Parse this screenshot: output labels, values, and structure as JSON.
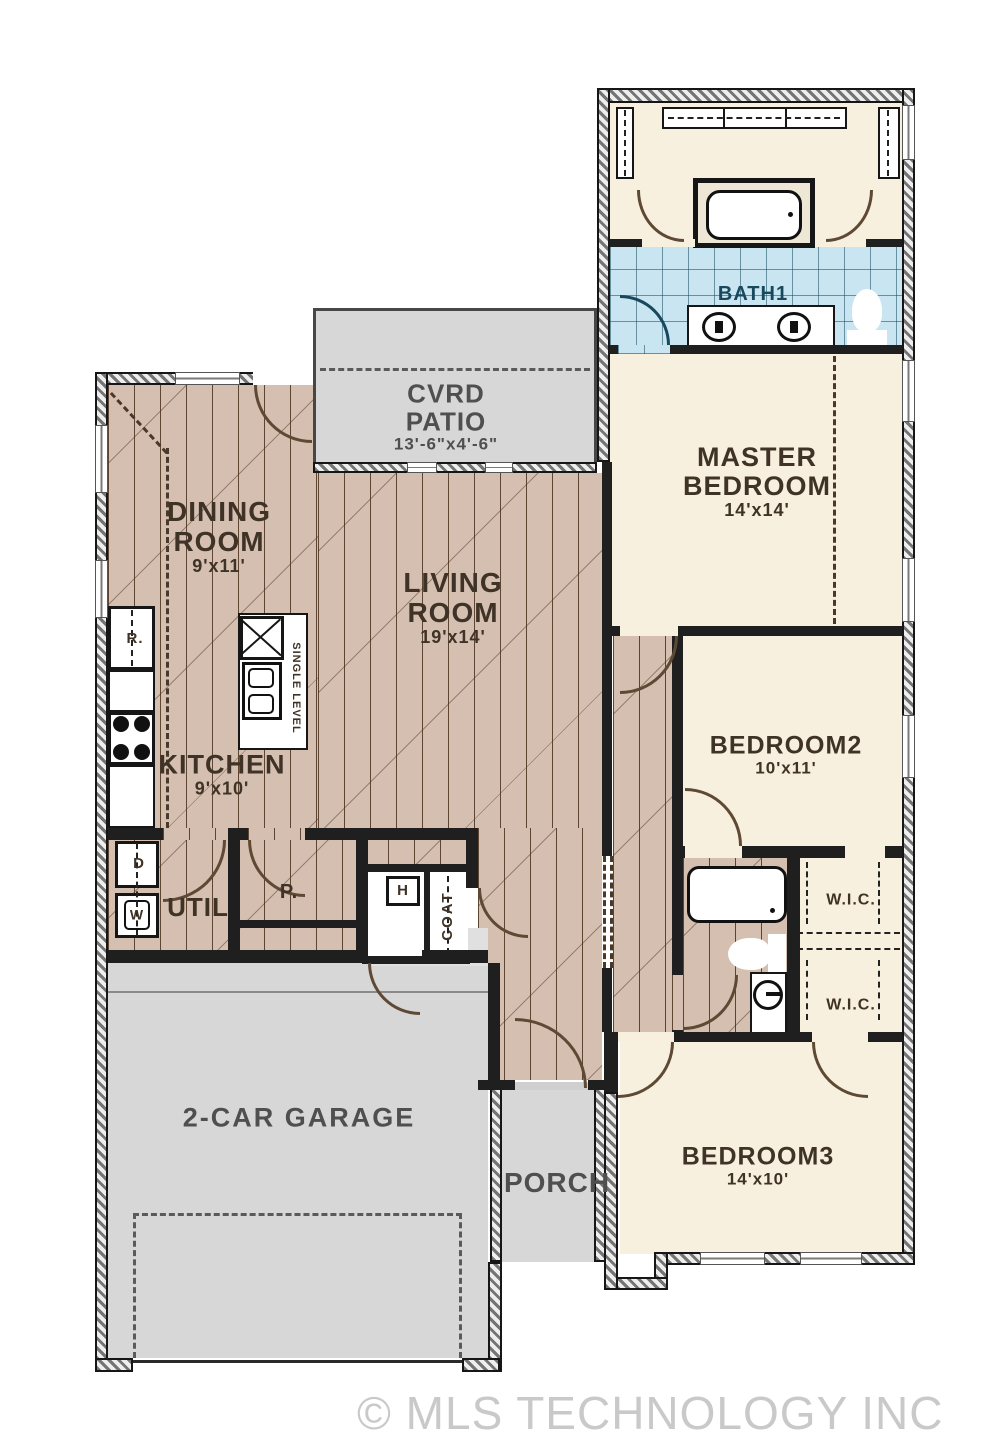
{
  "watermark": "© MLS TECHNOLOGY INC 2026",
  "rooms": {
    "bath1": {
      "label": "BATH1"
    },
    "master_bedroom": {
      "line1": "MASTER",
      "line2": "BEDROOM",
      "dims": "14'x14'"
    },
    "cvrd_patio": {
      "line1": "CVRD",
      "line2": "PATIO",
      "dims": "13'-6\"x4'-6\""
    },
    "dining_room": {
      "line1": "DINING",
      "line2": "ROOM",
      "dims": "9'x11'"
    },
    "living_room": {
      "line1": "LIVING",
      "line2": "ROOM",
      "dims": "19'x14'"
    },
    "kitchen": {
      "label": "KITCHEN",
      "dims": "9'x10'"
    },
    "bedroom2": {
      "label": "BEDROOM2",
      "dims": "10'x11'"
    },
    "bedroom3": {
      "label": "BEDROOM3",
      "dims": "14'x10'"
    },
    "garage": {
      "label": "2-CAR GARAGE"
    },
    "porch": {
      "label": "PORCH"
    },
    "util": {
      "label": "UTIL"
    },
    "pantry": {
      "label": "P."
    },
    "coat": {
      "label": "COAT"
    },
    "wic_upper": {
      "label": "W.I.C."
    },
    "wic_lower": {
      "label": "W.I.C."
    },
    "water_heater": {
      "label": "H"
    }
  },
  "appliances": {
    "refrigerator": "R.",
    "dryer": "D",
    "washer": "W",
    "kitchen_island_sink": "SINGLE LEVEL"
  },
  "colors": {
    "wood_floor": "#d4bfb1",
    "carpet_floor": "#f8f0de",
    "tile_floor": "#c9e5f2",
    "concrete_floor": "#d7d7d7",
    "wall": "#1f1f1f",
    "room_label": "#3f3226",
    "outdoor_label": "#4f4f4f",
    "bath_label": "#17485c",
    "door_arc": "#5e4934",
    "watermark": "#c9c9c9"
  }
}
